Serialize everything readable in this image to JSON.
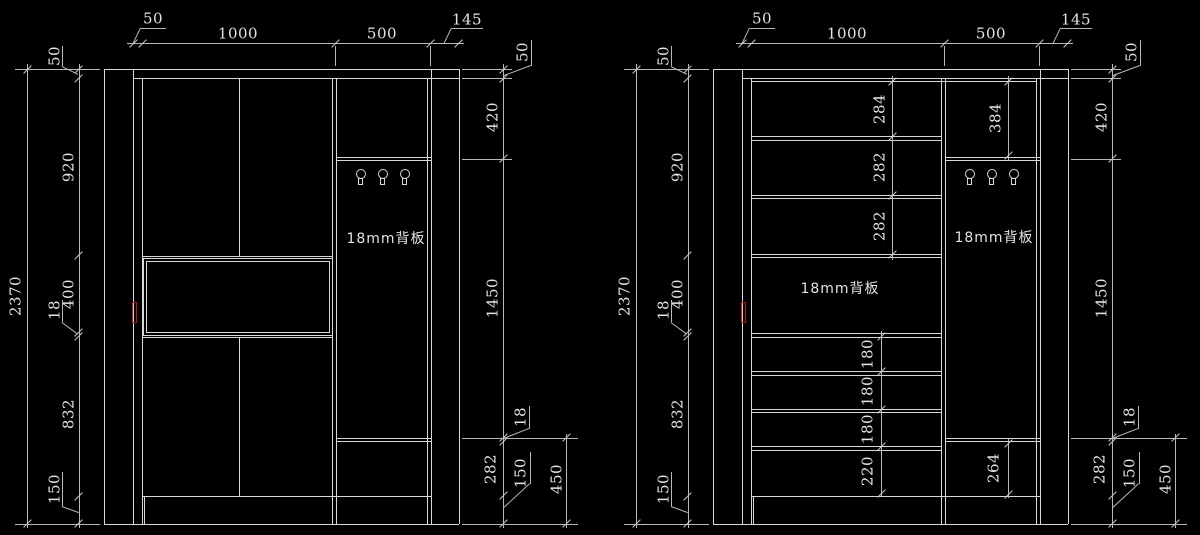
{
  "drawing": {
    "background_color": "#000000",
    "line_color": "#d7d7d7",
    "dim_line_color": "#b9b9b9",
    "text_color": "#e3e3e3",
    "handle_color": "#b51414",
    "views": [
      {
        "id": "left-elevation",
        "top_dims": [
          "50",
          "1000",
          "500",
          "145"
        ],
        "height_total": "2370",
        "left_dims": [
          "50",
          "920",
          "400",
          "18",
          "832",
          "150"
        ],
        "right_dims": [
          "50",
          "420",
          "1450",
          "18",
          "282",
          "150"
        ],
        "right_extra_dim": "450",
        "back_panel_label": "18mm背板",
        "hook_count": 3
      },
      {
        "id": "right-elevation",
        "top_dims": [
          "50",
          "1000",
          "500",
          "145"
        ],
        "height_total": "2370",
        "left_dims": [
          "50",
          "920",
          "400",
          "18",
          "832",
          "150"
        ],
        "right_dims": [
          "50",
          "420",
          "1450",
          "18",
          "282",
          "150"
        ],
        "right_extra_dim": "450",
        "shelf_dims": [
          "284",
          "282",
          "282"
        ],
        "upper_right_dim": "384",
        "drawer_dims": [
          "180",
          "180",
          "180",
          "220"
        ],
        "lower_right_dim": "264",
        "back_panel_label_main": "18mm背板",
        "back_panel_label_side": "18mm背板",
        "hook_count": 3
      }
    ]
  }
}
